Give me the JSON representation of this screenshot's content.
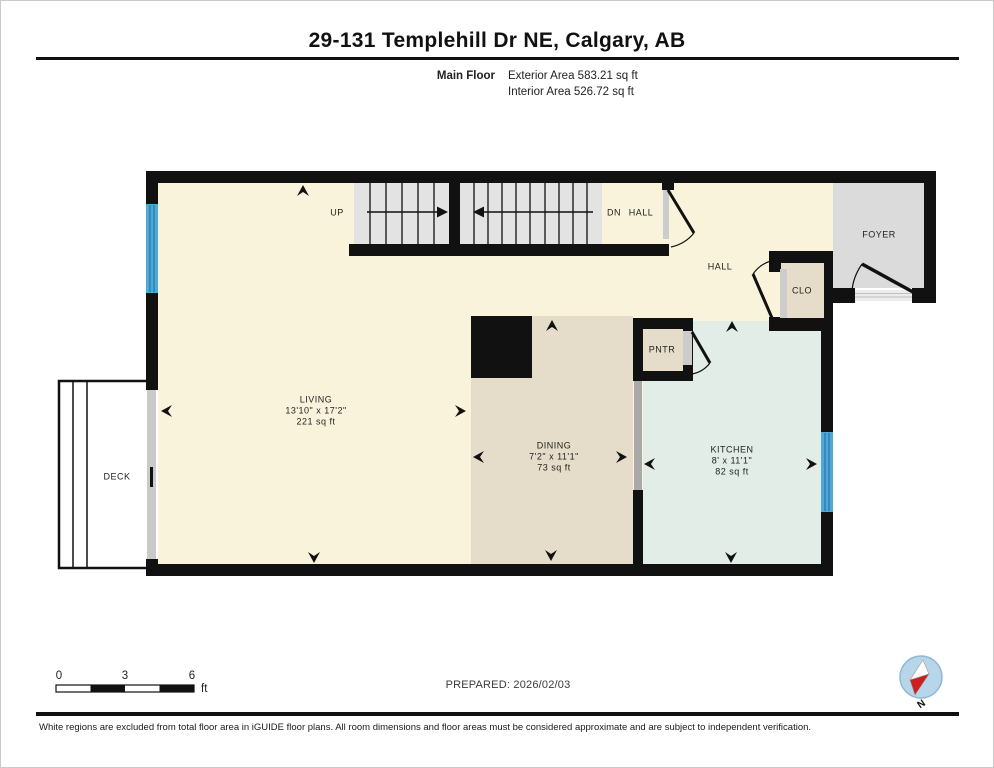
{
  "header": {
    "title": "29-131 Templehill Dr NE, Calgary, AB",
    "floor_label": "Main Floor",
    "exterior_area": "Exterior Area 583.21 sq ft",
    "interior_area": "Interior Area 526.72 sq ft"
  },
  "plan": {
    "living": {
      "name": "LIVING",
      "dims": "13'10\" x 17'2\"",
      "area": "221 sq ft"
    },
    "dining": {
      "name": "DINING",
      "dims": "7'2\" x 11'1\"",
      "area": "73 sq ft"
    },
    "kitchen": {
      "name": "KITCHEN",
      "dims": "8' x 11'1\"",
      "area": "82 sq ft"
    },
    "deck": {
      "name": "DECK"
    },
    "foyer": {
      "name": "FOYER"
    },
    "hall_upper": {
      "name": "HALL"
    },
    "hall_lower": {
      "name": "HALL"
    },
    "closet": {
      "name": "CLO"
    },
    "pantry": {
      "name": "PNTR"
    },
    "stairs_up": {
      "name": "UP"
    },
    "stairs_dn": {
      "name": "DN"
    }
  },
  "footer": {
    "scale": {
      "zero": "0",
      "three": "3",
      "six": "6",
      "unit": "ft"
    },
    "prepared": "PREPARED: 2026/02/03",
    "compass_label": "N",
    "disclaimer": "White regions are excluded from total floor area in iGUIDE floor plans. All room dimensions and floor areas must be considered approximate and are subject to independent verification."
  },
  "colors": {
    "wall": "#111111",
    "floor_cream": "#faf3dc",
    "dining_beige": "#e5ddc9",
    "kitchen_mint": "#e1ede6",
    "foyer_gray": "#dbdbdb",
    "stair_gray": "#e3e3e3",
    "window_blue": "#4fa8d6",
    "compass_blue": "#b7d6ea",
    "compass_red": "#cc1f1f"
  }
}
